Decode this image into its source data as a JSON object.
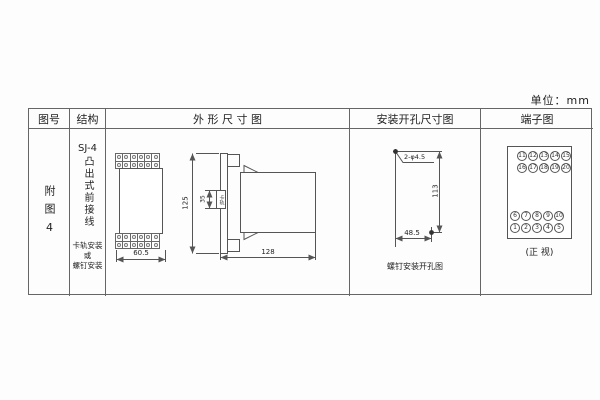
{
  "unit": "单位：mm",
  "headers": {
    "fig_no": "图号",
    "structure": "结构",
    "outline": "外 形 尺 寸 图",
    "mounting": "安装开孔尺寸图",
    "terminal": "端子图"
  },
  "fig_no": {
    "text": "附图4"
  },
  "structure": {
    "model": "SJ-4",
    "type_chars": "凸出式前接线",
    "note1": "卡轨安装",
    "note2": "或",
    "note3": "螺钉安装"
  },
  "outline": {
    "front_width": "60.5",
    "height": "125",
    "rail": "35",
    "rail_label": "卡轨",
    "depth": "128"
  },
  "mounting": {
    "hole_label": "2-φ4.5",
    "vertical_spacing": "113",
    "horizontal_spacing": "48.5",
    "caption": "螺钉安装开孔图"
  },
  "terminal": {
    "caption": "(正 视)",
    "top1": [
      "11",
      "12",
      "13",
      "14",
      "15"
    ],
    "top2": [
      "16",
      "17",
      "18",
      "19",
      "20"
    ],
    "bot1": [
      "6",
      "7",
      "8",
      "9",
      "10"
    ],
    "bot2": [
      "1",
      "2",
      "3",
      "4",
      "5"
    ]
  }
}
